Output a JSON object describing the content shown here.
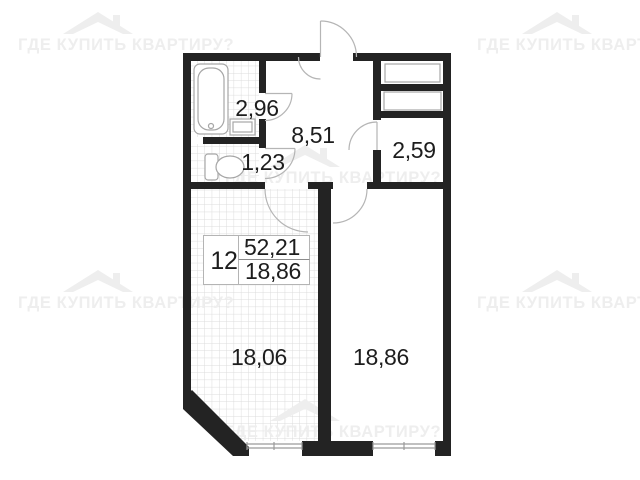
{
  "watermark": {
    "text": "ГДЕ КУПИТЬ КВАРТИРУ?",
    "color": "#eeeeee"
  },
  "unit_label": {
    "number": "12",
    "total_area": "52,21",
    "living_area": "18,86"
  },
  "rooms": {
    "bathroom": {
      "area": "2,96"
    },
    "wc": {
      "area": "1,23"
    },
    "hallway": {
      "area": "8,51"
    },
    "closet": {
      "area": "2,59"
    },
    "room_left": {
      "area": "18,06"
    },
    "room_right": {
      "area": "18,86"
    }
  },
  "colors": {
    "wall": "#232323",
    "tile_line": "#dcdcdc",
    "fixture_line": "#a6a6a6",
    "door_line": "#b5b5b5",
    "window_line": "#9a9a9a",
    "label_text": "#1d1d1d",
    "label_box_border": "#b4b4b4",
    "fraction_line": "#8c8c8c"
  }
}
